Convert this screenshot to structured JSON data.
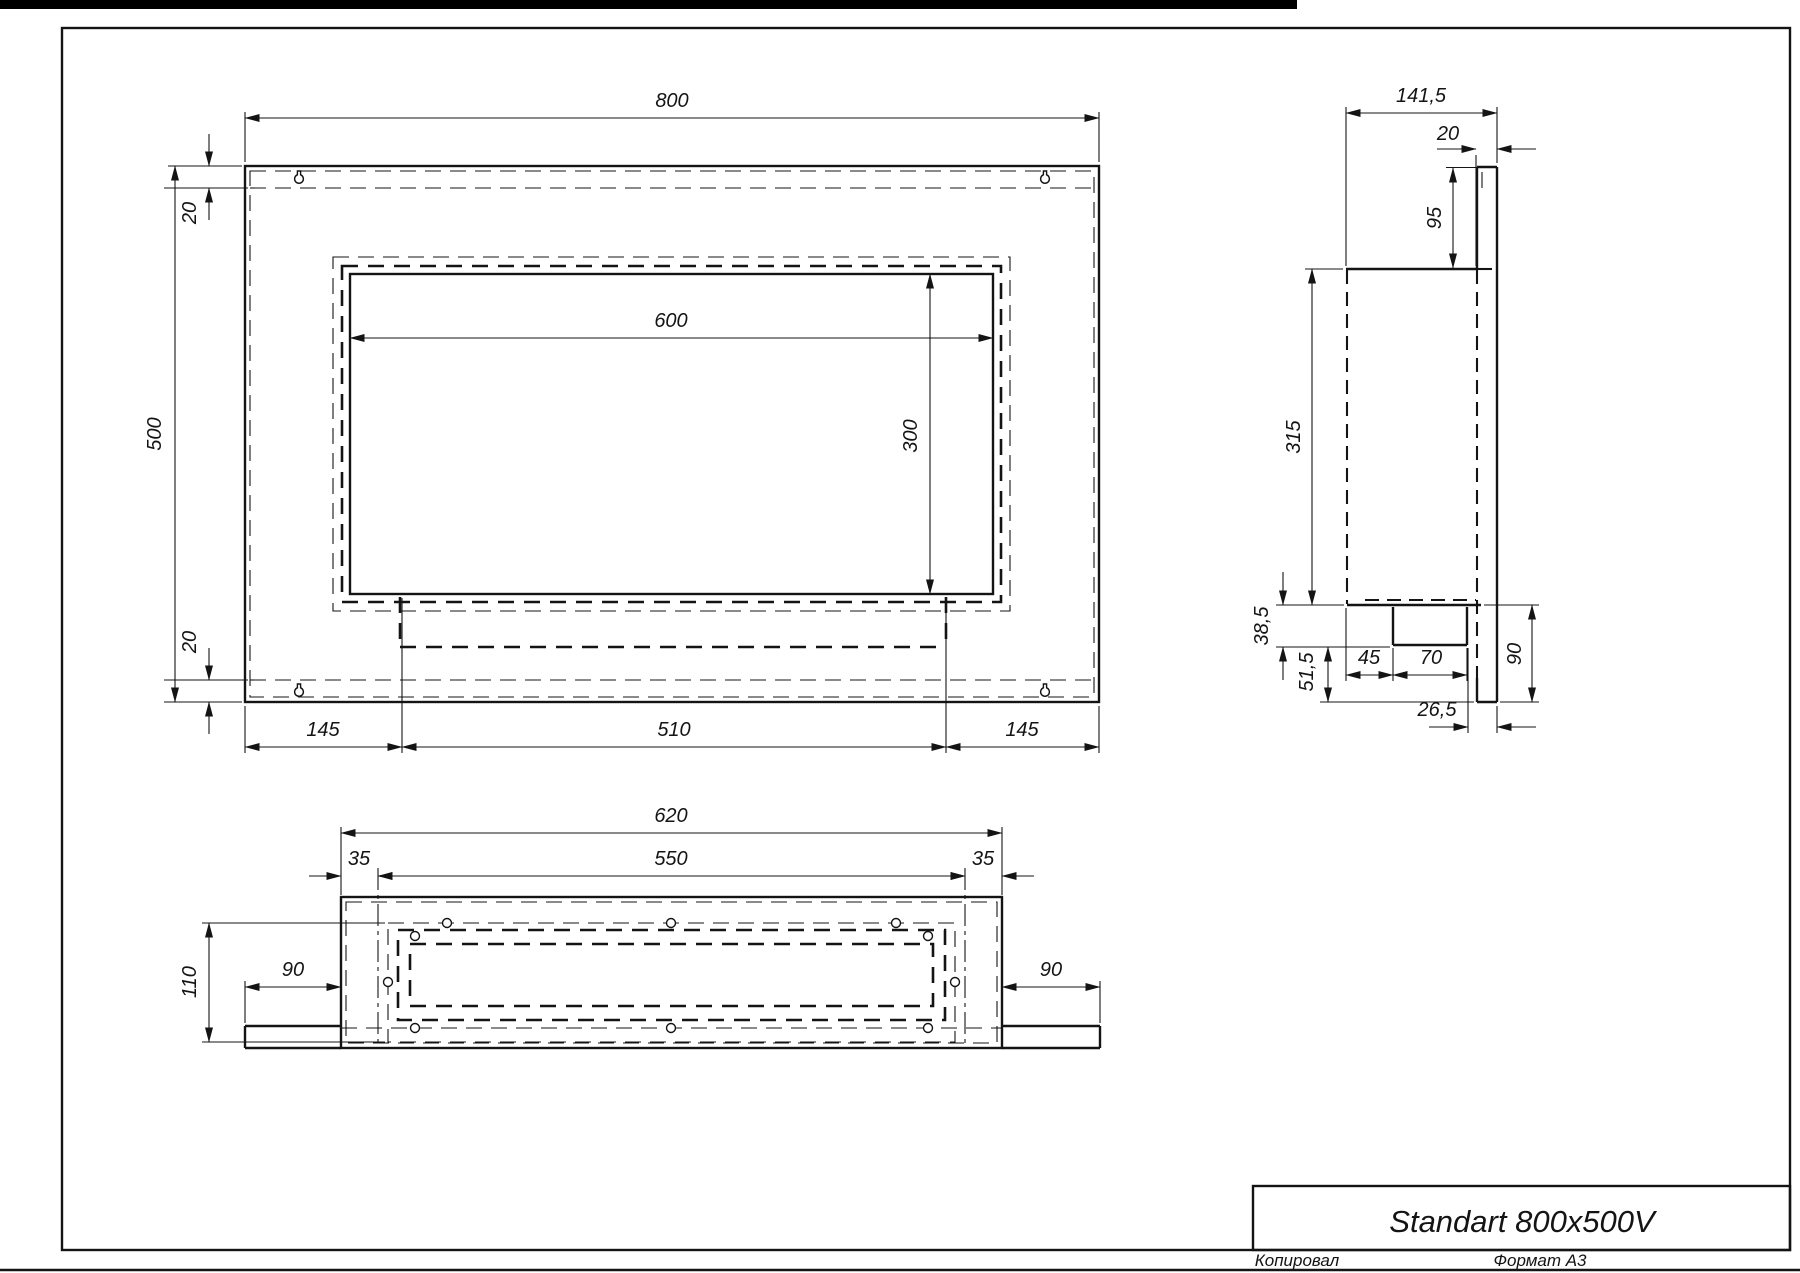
{
  "drawing": {
    "background": "#ffffff",
    "line_color": "#141414",
    "top_bar_color": "#000000"
  },
  "front_view": {
    "dims": {
      "total_width": "800",
      "total_height": "500",
      "top_inset": "20",
      "bottom_inset": "20",
      "opening_width": "600",
      "opening_height": "300",
      "bottom_left": "145",
      "bottom_center": "510",
      "bottom_right": "145"
    }
  },
  "side_view": {
    "dims": {
      "total_depth": "141,5",
      "back_plate_thickness": "20",
      "upper_plate_height": "95",
      "body_height": "315",
      "tray_height": "38,5",
      "lower_gap": "51,5",
      "tray_front_offset": "45",
      "tray_width": "70",
      "tray_back_offset": "26,5",
      "lower_height": "90"
    }
  },
  "bottom_view": {
    "dims": {
      "outer_width": "620",
      "inner_width": "550",
      "left_inset": "35",
      "right_inset": "35",
      "total_depth": "110",
      "left_flange": "90",
      "right_flange": "90"
    }
  },
  "title_block": {
    "title": "Standart 800x500V"
  },
  "footer": {
    "copied": "Копировал",
    "format": "Формат А3"
  }
}
